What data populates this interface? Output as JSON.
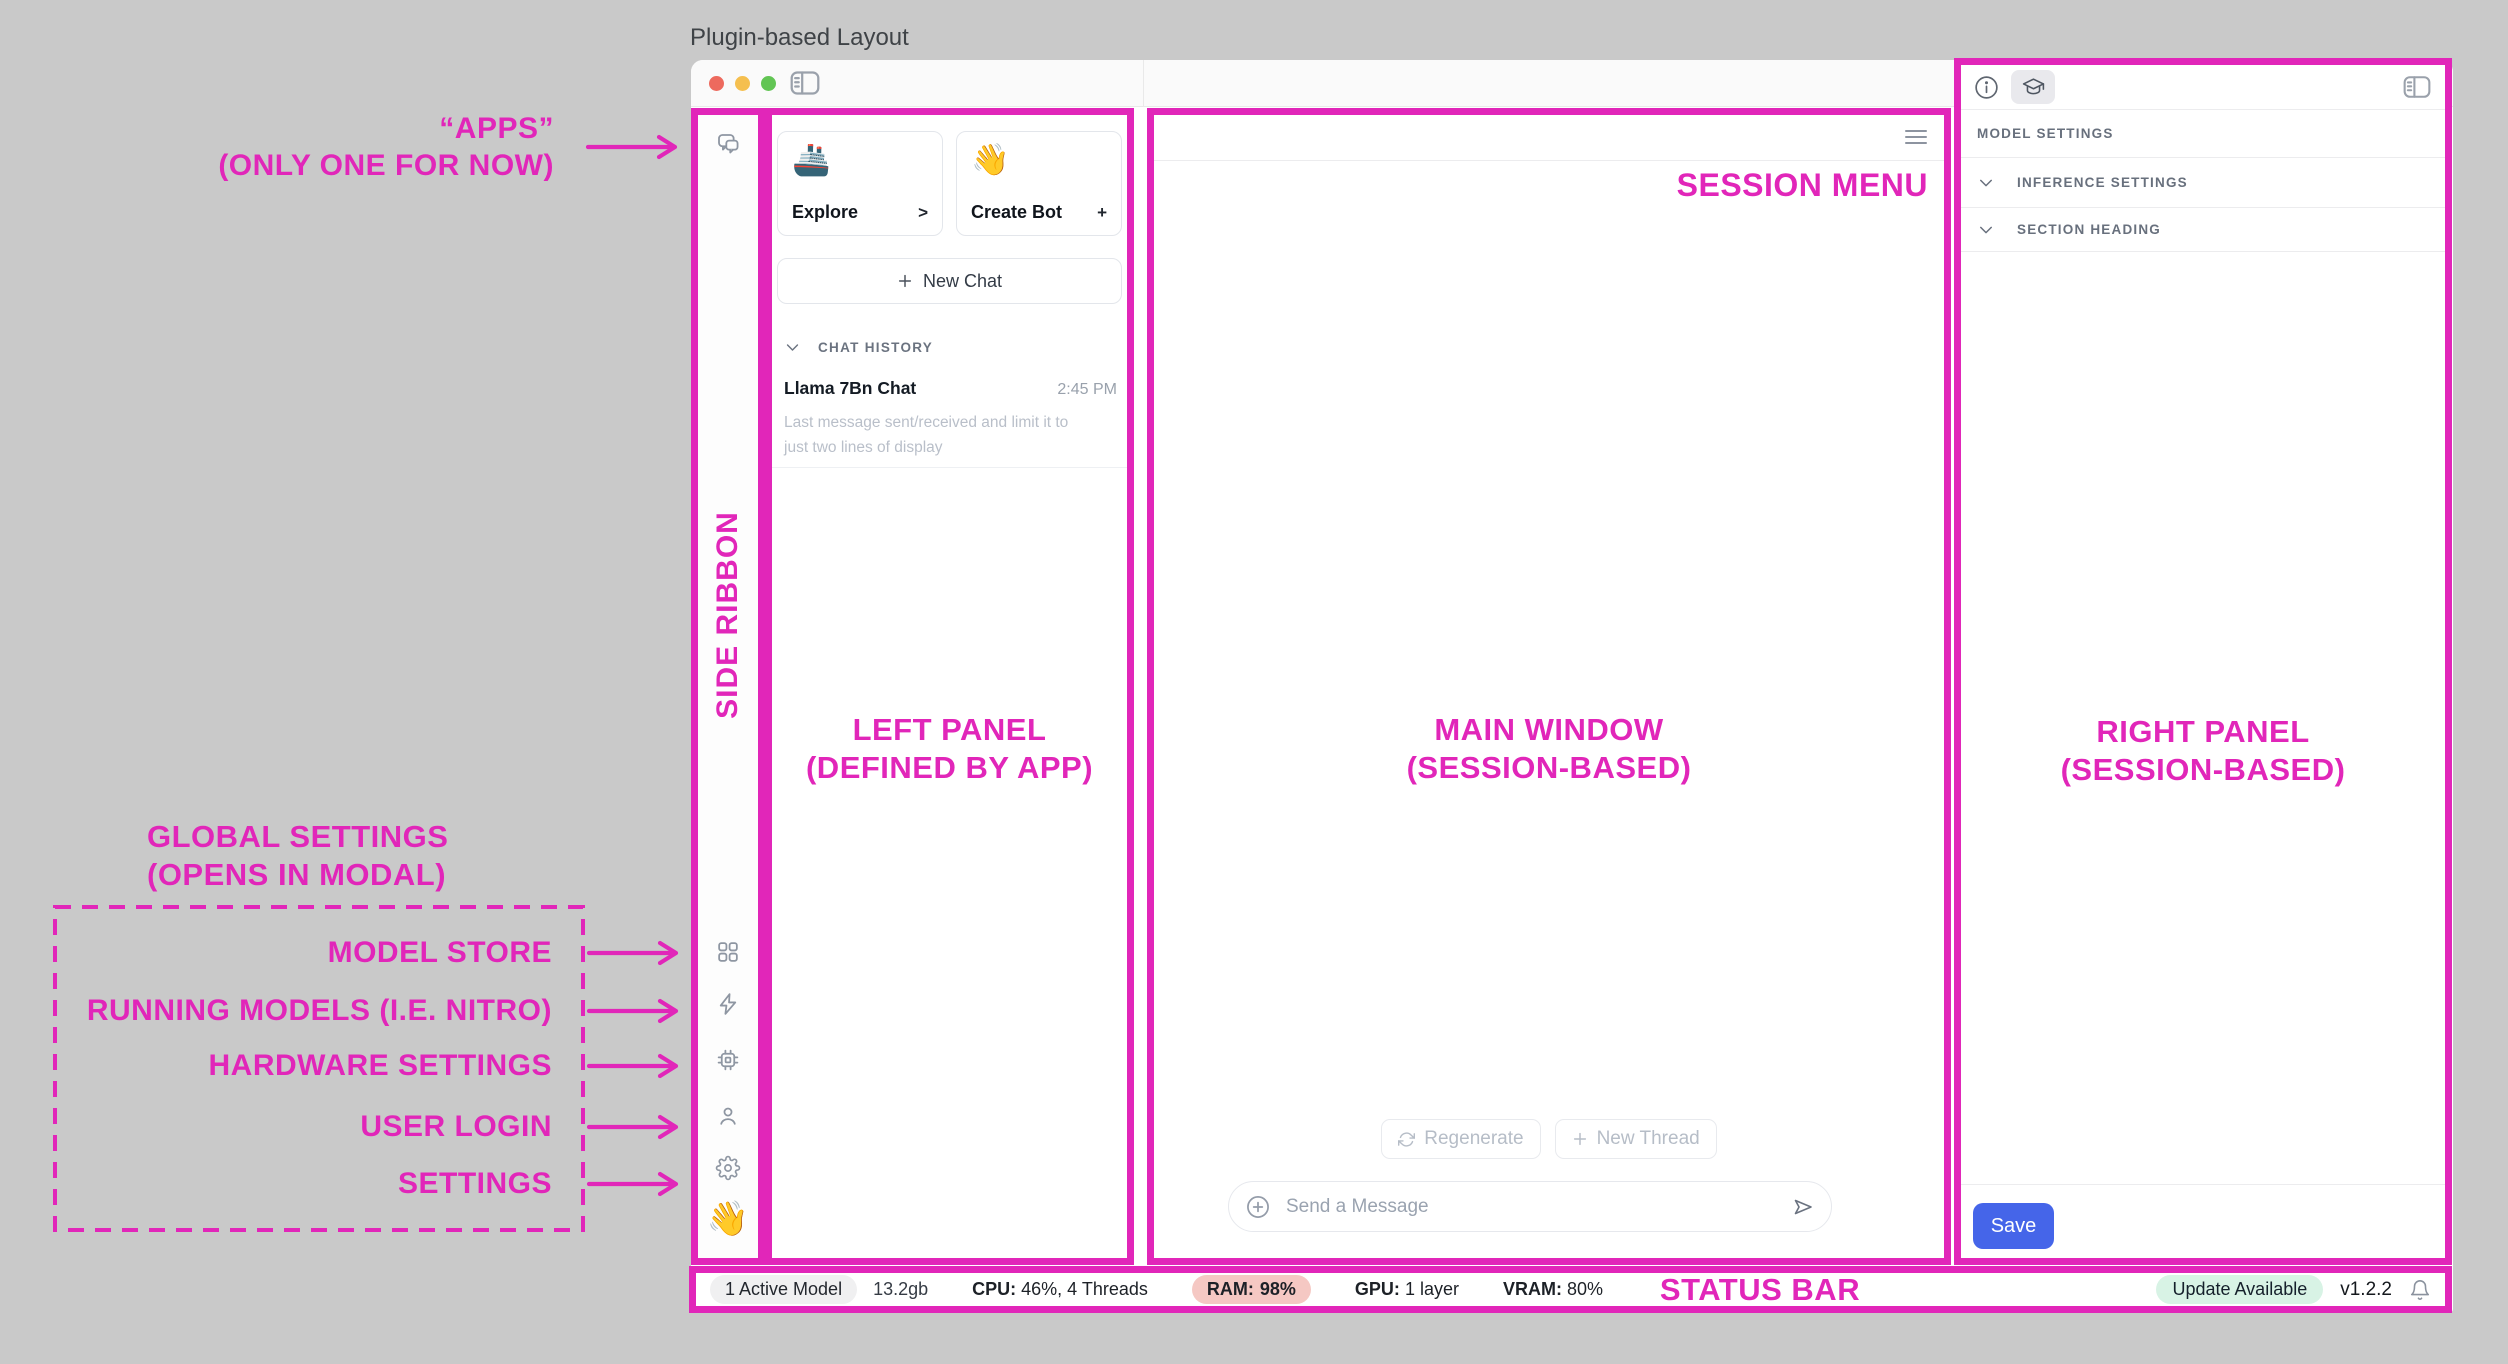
{
  "page": {
    "title": "Plugin-based Layout"
  },
  "colors": {
    "accent_pink": "#E126B9",
    "save_blue": "#4565E9",
    "ram_pill_bg": "#F5C8C3",
    "update_pill_bg": "#D8F3E5",
    "traffic_red": "#ED6A5E",
    "traffic_yellow": "#F5BF4F",
    "traffic_green": "#62C554"
  },
  "annotations": {
    "apps_line1": "“APPS”",
    "apps_line2": "(ONLY ONE FOR NOW)",
    "side_ribbon": "SIDE RIBBON",
    "left_panel_line1": "LEFT PANEL",
    "left_panel_line2": "(DEFINED BY APP)",
    "main_window_line1": "MAIN WINDOW",
    "main_window_line2": "(SESSION-BASED)",
    "right_panel_line1": "RIGHT PANEL",
    "right_panel_line2": "(SESSION-BASED)",
    "session_menu": "SESSION MENU",
    "status_bar": "STATUS BAR",
    "global_settings_line1": "GLOBAL SETTINGS",
    "global_settings_line2": "(OPENS IN MODAL)",
    "ribbon_items": [
      "MODEL STORE",
      "RUNNING MODELS (I.E. NITRO)",
      "HARDWARE SETTINGS",
      "USER LOGIN",
      "SETTINGS"
    ]
  },
  "left_panel": {
    "explore": {
      "emoji": "🚢",
      "label": "Explore",
      "affordance": ">"
    },
    "create_bot": {
      "emoji": "👋",
      "label": "Create Bot",
      "affordance": "+"
    },
    "new_chat_label": "New Chat",
    "chat_history_header": "CHAT HISTORY",
    "chat_item": {
      "title": "Llama 7Bn Chat",
      "time": "2:45 PM",
      "preview": "Last message sent/received and limit it to just two lines of display"
    }
  },
  "main_window": {
    "regenerate_label": "Regenerate",
    "new_thread_label": "New Thread",
    "composer_placeholder": "Send a Message"
  },
  "right_panel": {
    "model_settings_header": "MODEL SETTINGS",
    "sections": [
      "INFERENCE SETTINGS",
      "SECTION HEADING"
    ],
    "save_label": "Save"
  },
  "status_bar": {
    "active_model": "1 Active Model",
    "memory": "13.2gb",
    "cpu_label": "CPU:",
    "cpu_value": "46%, 4 Threads",
    "ram_label": "RAM:",
    "ram_value": "98%",
    "gpu_label": "GPU:",
    "gpu_value": "1 layer",
    "vram_label": "VRAM:",
    "vram_value": "80%",
    "update_label": "Update Available",
    "version": "v1.2.2"
  },
  "ribbon": {
    "wave_emoji": "👋"
  }
}
